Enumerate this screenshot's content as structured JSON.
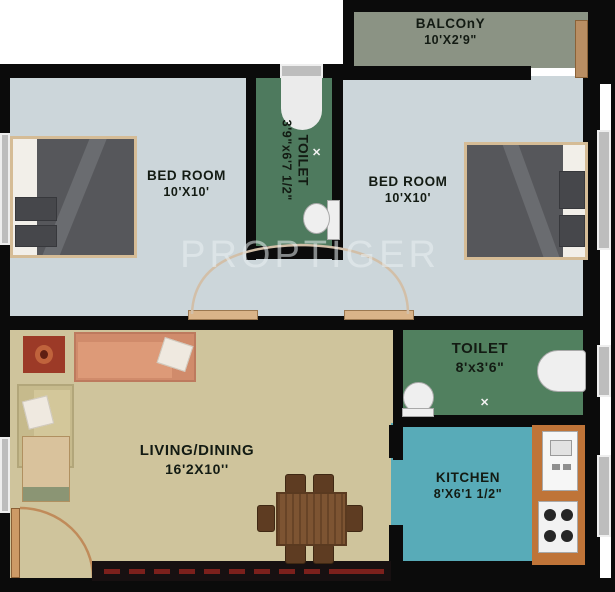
{
  "watermark": {
    "text": "PROPTIGER"
  },
  "rooms": {
    "balcony": {
      "name": "BALCOnY",
      "dims": "10'X2'9\""
    },
    "bedroom_left": {
      "name": "BED ROOM",
      "dims": "10'X10'"
    },
    "bedroom_right": {
      "name": "BED ROOM",
      "dims": "10'X10'"
    },
    "toilet_top": {
      "name": "TOILET",
      "dims": "3'9\"x6'7 1/2\""
    },
    "toilet_right": {
      "name": "TOILET",
      "dims": "8'x3'6\""
    },
    "kitchen": {
      "name": "KITCHEN",
      "dims": "8'X6'1 1/2\""
    },
    "living_dining": {
      "name": "LIVING/DINING",
      "dims": "16'2X10''"
    }
  },
  "symbols": {
    "floor_drain": "✕"
  },
  "colors": {
    "wall": "#0b0b0b",
    "bedroom_floor": "#ccd6da",
    "toilet_floor": "#4e7a5e",
    "balcony_floor": "#8b9384",
    "living_floor": "#cfc49c",
    "kitchen_floor": "#58abb8",
    "kitchen_counter": "#bf7438",
    "door_sill": "#dab489",
    "rug": "#9c3a27",
    "watermark": "#eaf0f2"
  }
}
